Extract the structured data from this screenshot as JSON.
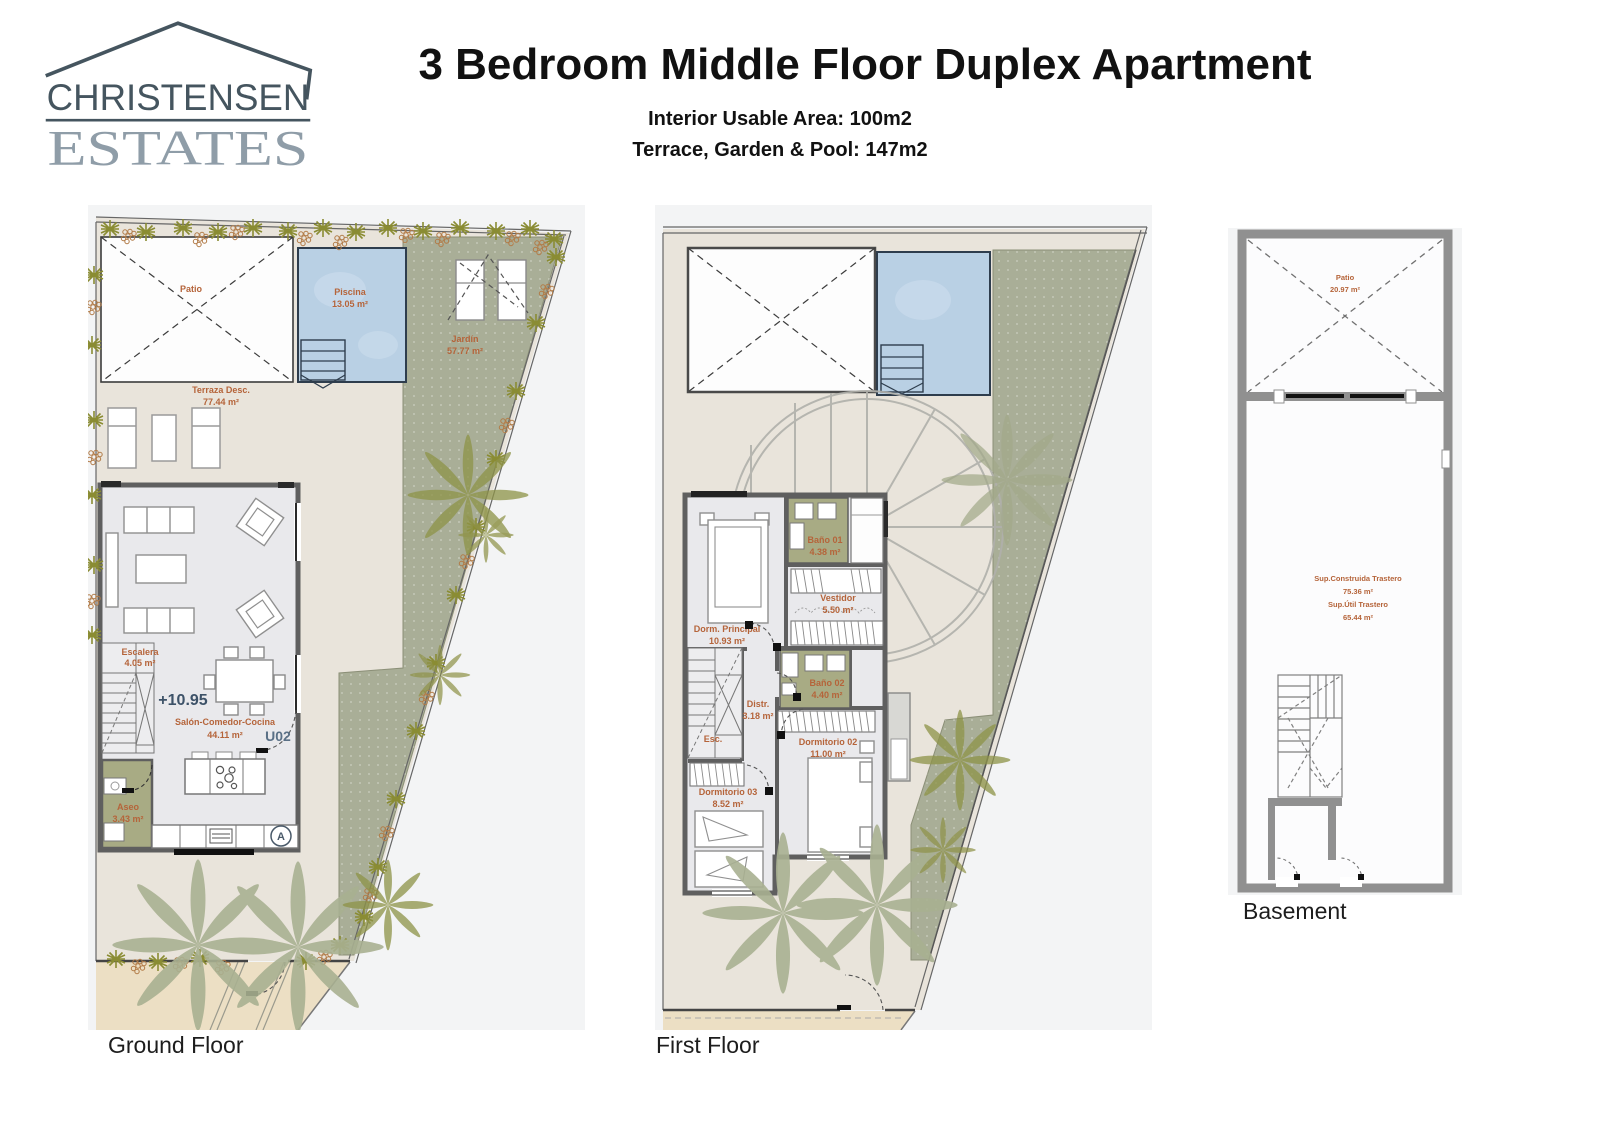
{
  "header": {
    "logo": {
      "line1": "CHRISTENSEN",
      "line2": "ESTATES"
    },
    "title": "3 Bedroom Middle Floor Duplex Apartment",
    "subtitle1": "Interior Usable Area: 100m2",
    "subtitle2": "Terrace, Garden & Pool: 147m2"
  },
  "plans": {
    "ground": {
      "caption": "Ground Floor",
      "labels": {
        "patio": "Patio",
        "piscina_n": "Piscina",
        "piscina_a": "13.05 m²",
        "jardin_n": "Jardín",
        "jardin_a": "57.77 m²",
        "terraza_n": "Terraza Desc.",
        "terraza_a": "77.44 m²",
        "escalera_n": "Escalera",
        "escalera_a": "4.05 m²",
        "level": "+10.95",
        "salon_n": "Salón-Comedor-Cocina",
        "salon_a": "44.11 m²",
        "unit": "U02",
        "aseo_n": "Aseo",
        "aseo_a": "3.43 m²",
        "marker": "A"
      }
    },
    "first": {
      "caption": "First Floor",
      "labels": {
        "bano01_n": "Baño 01",
        "bano01_a": "4.38 m²",
        "vestidor_n": "Vestidor",
        "vestidor_a": "5.50 m²",
        "dormp_n": "Dorm. Principal",
        "dormp_a": "10.93 m²",
        "bano02_n": "Baño 02",
        "bano02_a": "4.40 m²",
        "distr_n": "Distr.",
        "distr_a": "3.18 m²",
        "dorm02_n": "Dormitorio 02",
        "dorm02_a": "11.00 m²",
        "dorm03_n": "Dormitorio 03",
        "dorm03_a": "8.52 m²",
        "esc": "Esc."
      }
    },
    "basement": {
      "caption": "Basement",
      "labels": {
        "patio_n": "Patio",
        "patio_a": "20.97 m²",
        "l1": "Sup.Construida Trastero",
        "l2": "75.36 m²",
        "l3": "Sup.Útil Trastero",
        "l4": "65.44 m²"
      }
    }
  },
  "palette": {
    "logo_dark": "#45555f",
    "logo_light": "#8f9da8",
    "label_orange": "#b5643a",
    "level_blue": "#3d5268",
    "pool_blue": "#b9d0e4",
    "pool_border": "#2e3d4d",
    "garden_green": "#a9ae97",
    "bath_green": "#a8ab84",
    "wall_gray": "#5f5f5f",
    "stone": "#e9e4db",
    "sidewalk_beige": "#ecdfc4",
    "palm_sage": "#a9b091",
    "palm_olive": "#8f9349",
    "bush_olive": "#8a8c33",
    "flower_brown": "#b27b47"
  }
}
